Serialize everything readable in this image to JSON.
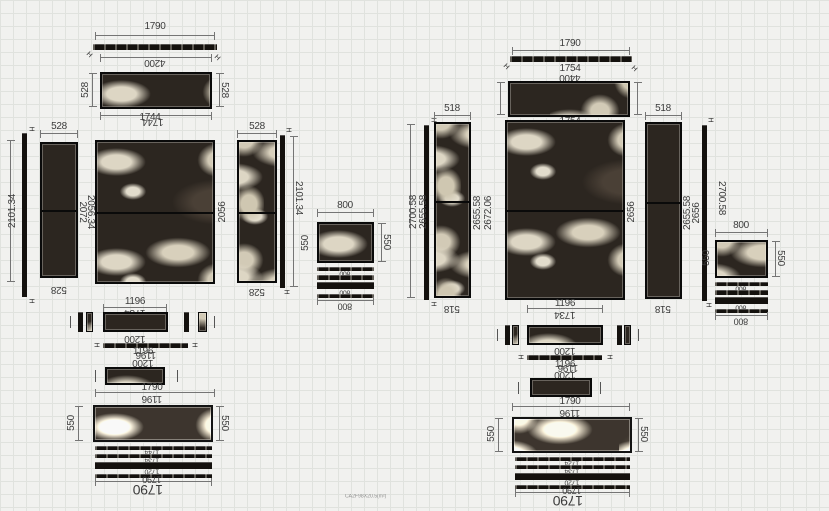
{
  "app": {
    "caption": "CA2F98X20.5(m²)"
  },
  "left": {
    "top_width": "1790",
    "top_strip_len": "4200",
    "strip_h": "528",
    "strip_len": "1744",
    "col_w": "528",
    "h_outer": "2101.34",
    "h_mid": "2072",
    "h_inner": "2056.34",
    "h_right": "2056",
    "side_w": "800",
    "side_h": "550",
    "row_w": "1196",
    "row_sub": "1734",
    "row_w2": "1200",
    "bottom_w": "1790",
    "bottom_h": "550",
    "skirt1": "1744",
    "skirt2": "1734",
    "skirt3": "1720",
    "total_w": "1790"
  },
  "right": {
    "top_width": "1790",
    "top_strip_len": "4400",
    "strip_len": "1754",
    "col_w": "518",
    "h_outer": "2700.58",
    "h_mid": "2655.58",
    "h_inner": "2672.06",
    "h_right": "2656",
    "side_w": "800",
    "side_h": "550",
    "row_w": "1196",
    "row_sub": "1734",
    "row_w2": "1200",
    "bottom_w": "1790",
    "bottom_h": "550",
    "skirt1": "1724",
    "skirt2": "1734",
    "skirt3": "1720",
    "total_w": "1790"
  }
}
